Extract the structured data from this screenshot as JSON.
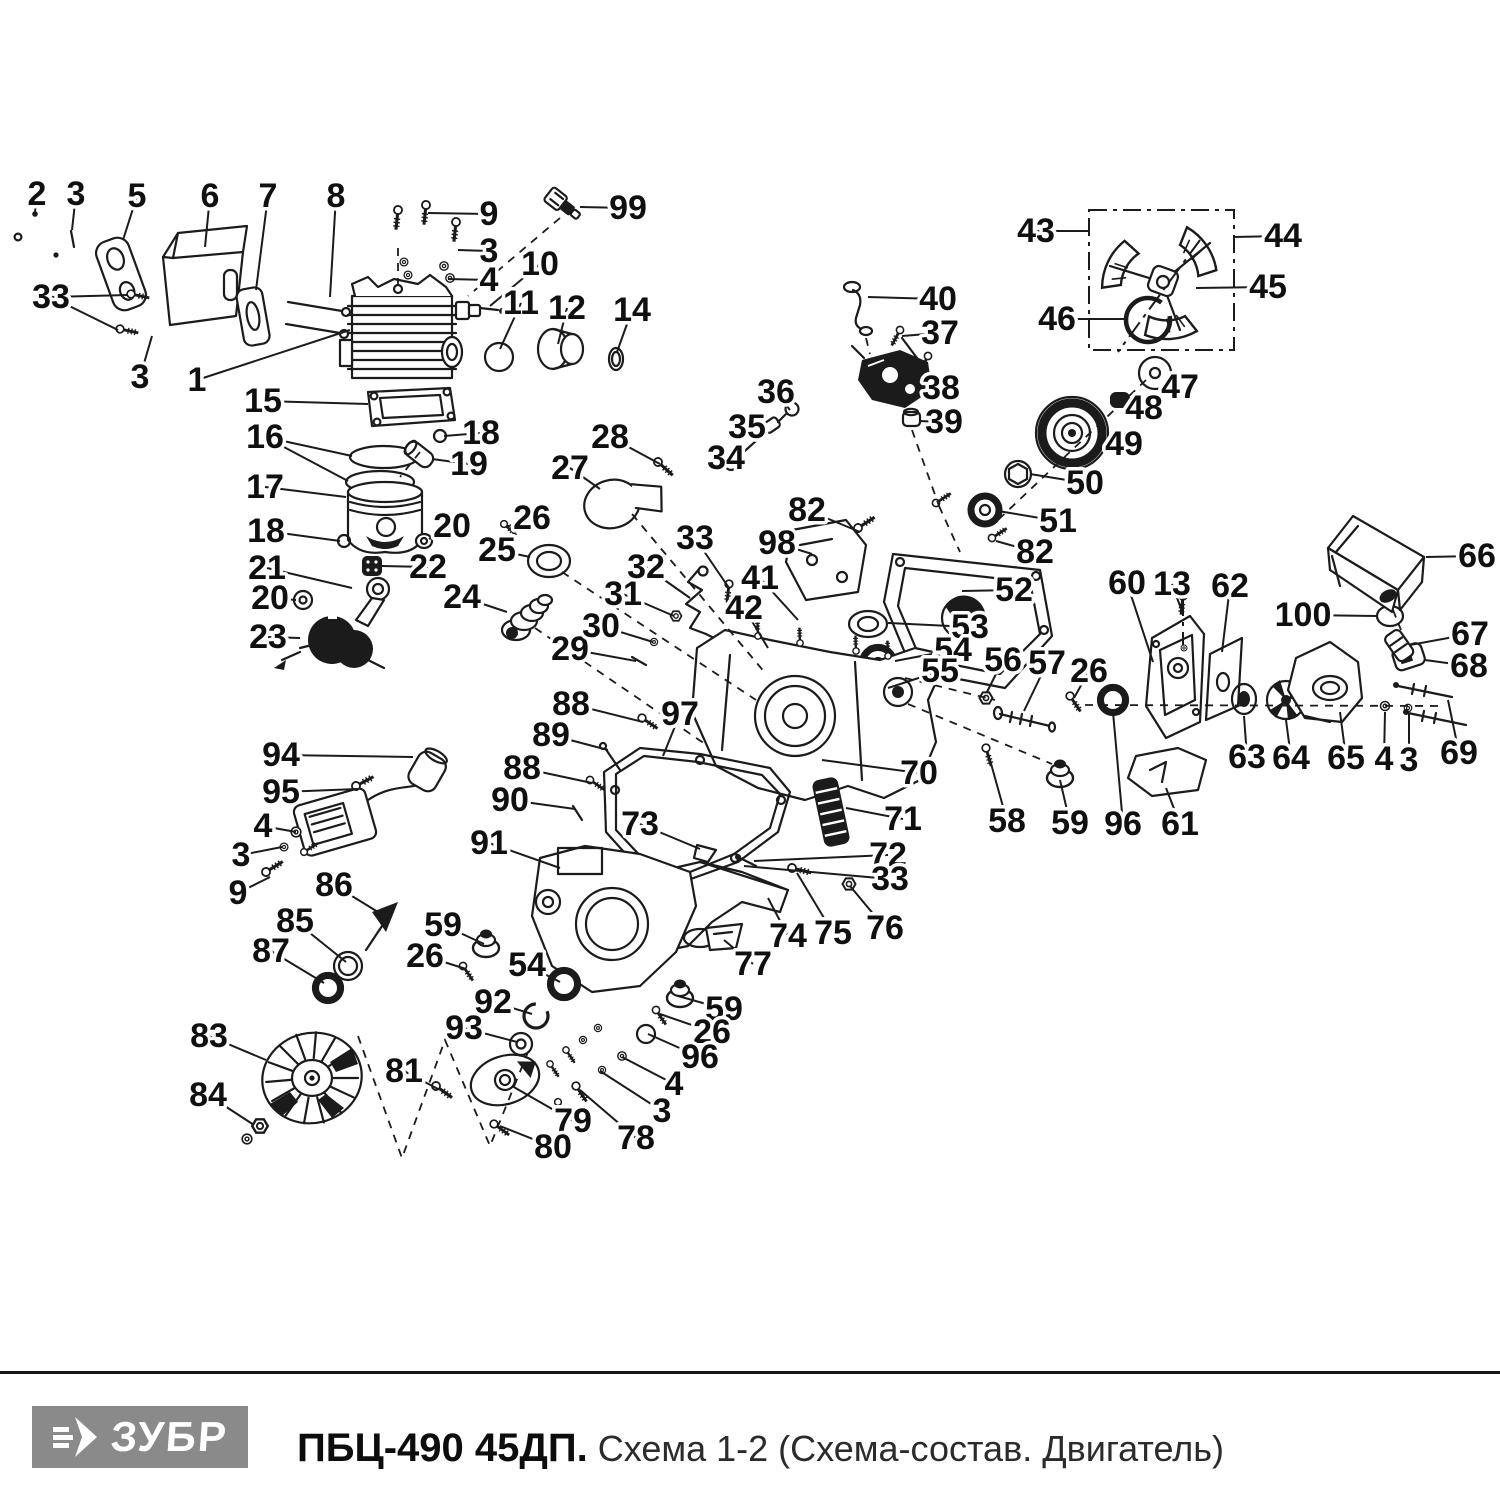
{
  "footer": {
    "brand": "ЗУБР",
    "model": "ПБЦ-490 45ДП.",
    "subtitle": " Схема 1-2 (Схема-состав. Двигатель)"
  },
  "colors": {
    "ink": "#1b1b1b",
    "logo_bg": "#8a8a8a",
    "logo_text": "#ffffff",
    "paper": "#ffffff"
  },
  "diagram": {
    "description": "Exploded engine parts schematic with numbered callouts",
    "labels": [
      {
        "n": "2",
        "x": 37,
        "y": 194,
        "t": [
          [
            35,
            212
          ]
        ]
      },
      {
        "n": "3",
        "x": 76,
        "y": 194,
        "t": [
          [
            72,
            230
          ]
        ]
      },
      {
        "n": "5",
        "x": 137,
        "y": 196,
        "t": [
          [
            123,
            240
          ]
        ]
      },
      {
        "n": "6",
        "x": 210,
        "y": 196,
        "t": [
          [
            205,
            247
          ]
        ]
      },
      {
        "n": "7",
        "x": 268,
        "y": 196,
        "t": [
          [
            256,
            290
          ]
        ]
      },
      {
        "n": "8",
        "x": 336,
        "y": 196,
        "t": [
          [
            330,
            297
          ]
        ]
      },
      {
        "n": "9",
        "x": 489,
        "y": 214,
        "t": [
          [
            428,
            213
          ]
        ]
      },
      {
        "n": "99",
        "x": 628,
        "y": 208,
        "t": [
          [
            580,
            207
          ]
        ]
      },
      {
        "n": "3",
        "x": 489,
        "y": 251,
        "t": [
          [
            458,
            250
          ]
        ]
      },
      {
        "n": "4",
        "x": 489,
        "y": 280,
        "t": [
          [
            448,
            279
          ]
        ]
      },
      {
        "n": "10",
        "x": 540,
        "y": 264,
        "t": [
          [
            490,
            306
          ]
        ]
      },
      {
        "n": "11",
        "x": 521,
        "y": 303,
        "t": [
          [
            500,
            349
          ]
        ]
      },
      {
        "n": "12",
        "x": 567,
        "y": 308,
        "t": [
          [
            558,
            344
          ]
        ]
      },
      {
        "n": "14",
        "x": 632,
        "y": 310,
        "t": [
          [
            617,
            352
          ]
        ]
      },
      {
        "n": "33",
        "x": 51,
        "y": 297,
        "t": [
          [
            128,
            295
          ],
          [
            118,
            330
          ]
        ]
      },
      {
        "n": "3",
        "x": 140,
        "y": 377,
        "t": [
          [
            152,
            336
          ]
        ]
      },
      {
        "n": "1",
        "x": 197,
        "y": 380,
        "t": [
          [
            350,
            330
          ]
        ]
      },
      {
        "n": "15",
        "x": 263,
        "y": 401,
        "t": [
          [
            368,
            404
          ]
        ]
      },
      {
        "n": "16",
        "x": 265,
        "y": 437,
        "t": [
          [
            352,
            456
          ],
          [
            348,
            481
          ]
        ]
      },
      {
        "n": "17",
        "x": 265,
        "y": 487,
        "t": [
          [
            346,
            497
          ]
        ]
      },
      {
        "n": "18",
        "x": 266,
        "y": 531,
        "t": [
          [
            340,
            541
          ]
        ]
      },
      {
        "n": "18",
        "x": 481,
        "y": 433,
        "t": [
          [
            444,
            436
          ]
        ]
      },
      {
        "n": "19",
        "x": 469,
        "y": 464,
        "t": [
          [
            432,
            459
          ]
        ]
      },
      {
        "n": "20",
        "x": 452,
        "y": 526,
        "t": [
          [
            429,
            539
          ]
        ]
      },
      {
        "n": "22",
        "x": 428,
        "y": 567,
        "t": [
          [
            380,
            566
          ]
        ]
      },
      {
        "n": "21",
        "x": 267,
        "y": 568,
        "t": [
          [
            352,
            588
          ]
        ]
      },
      {
        "n": "20",
        "x": 270,
        "y": 598,
        "t": [
          [
            296,
            600
          ]
        ]
      },
      {
        "n": "23",
        "x": 268,
        "y": 637,
        "t": [
          [
            300,
            638
          ]
        ]
      },
      {
        "n": "26",
        "x": 532,
        "y": 518,
        "t": [
          [
            506,
            527
          ]
        ]
      },
      {
        "n": "25",
        "x": 497,
        "y": 550,
        "t": [
          [
            530,
            557
          ]
        ]
      },
      {
        "n": "24",
        "x": 462,
        "y": 597,
        "t": [
          [
            507,
            612
          ]
        ]
      },
      {
        "n": "27",
        "x": 570,
        "y": 468,
        "t": [
          [
            600,
            489
          ]
        ]
      },
      {
        "n": "28",
        "x": 610,
        "y": 437,
        "t": [
          [
            660,
            464
          ]
        ]
      },
      {
        "n": "36",
        "x": 776,
        "y": 392,
        "t": [
          [
            790,
            410
          ]
        ]
      },
      {
        "n": "35",
        "x": 747,
        "y": 427,
        "t": [
          [
            757,
            441
          ]
        ]
      },
      {
        "n": "34",
        "x": 726,
        "y": 458,
        "t": [
          [
            731,
            464
          ]
        ]
      },
      {
        "n": "40",
        "x": 938,
        "y": 299,
        "t": [
          [
            868,
            297
          ]
        ]
      },
      {
        "n": "37",
        "x": 940,
        "y": 333,
        "t": [
          [
            902,
            336
          ]
        ]
      },
      {
        "n": "38",
        "x": 941,
        "y": 388,
        "t": [
          [
            920,
            385
          ]
        ]
      },
      {
        "n": "39",
        "x": 944,
        "y": 422,
        "t": [
          [
            919,
            421
          ]
        ]
      },
      {
        "n": "43",
        "x": 1036,
        "y": 231,
        "t": [
          [
            1089,
            231
          ]
        ]
      },
      {
        "n": "44",
        "x": 1283,
        "y": 236,
        "t": [
          [
            1233,
            237
          ]
        ]
      },
      {
        "n": "45",
        "x": 1268,
        "y": 287,
        "t": [
          [
            1196,
            288
          ]
        ]
      },
      {
        "n": "46",
        "x": 1057,
        "y": 319,
        "t": [
          [
            1124,
            319
          ]
        ]
      },
      {
        "n": "47",
        "x": 1180,
        "y": 387,
        "t": [
          [
            1166,
            379
          ]
        ]
      },
      {
        "n": "48",
        "x": 1144,
        "y": 408,
        "t": [
          [
            1124,
            401
          ]
        ]
      },
      {
        "n": "49",
        "x": 1124,
        "y": 444,
        "t": [
          [
            1100,
            438
          ]
        ]
      },
      {
        "n": "50",
        "x": 1085,
        "y": 483,
        "t": [
          [
            1030,
            474
          ]
        ]
      },
      {
        "n": "51",
        "x": 1058,
        "y": 521,
        "t": [
          [
            998,
            511
          ]
        ]
      },
      {
        "n": "82",
        "x": 1035,
        "y": 552,
        "t": [
          [
            996,
            541
          ]
        ]
      },
      {
        "n": "66",
        "x": 1477,
        "y": 556,
        "t": [
          [
            1426,
            557
          ]
        ]
      },
      {
        "n": "100",
        "x": 1303,
        "y": 615,
        "t": [
          [
            1376,
            616
          ]
        ]
      },
      {
        "n": "67",
        "x": 1470,
        "y": 634,
        "t": [
          [
            1410,
            645
          ]
        ]
      },
      {
        "n": "68",
        "x": 1469,
        "y": 666,
        "t": [
          [
            1425,
            660
          ]
        ]
      },
      {
        "n": "52",
        "x": 1014,
        "y": 590,
        "t": [
          [
            962,
            591
          ]
        ]
      },
      {
        "n": "53",
        "x": 970,
        "y": 627,
        "t": [
          [
            888,
            623
          ]
        ]
      },
      {
        "n": "54",
        "x": 953,
        "y": 650,
        "t": [
          [
            895,
            661
          ]
        ]
      },
      {
        "n": "55",
        "x": 940,
        "y": 671,
        "t": [
          [
            888,
            688
          ]
        ]
      },
      {
        "n": "56",
        "x": 1003,
        "y": 660,
        "t": [
          [
            987,
            692
          ]
        ]
      },
      {
        "n": "57",
        "x": 1047,
        "y": 663,
        "t": [
          [
            1024,
            711
          ]
        ]
      },
      {
        "n": "26",
        "x": 1089,
        "y": 671,
        "t": [
          [
            1074,
            698
          ]
        ]
      },
      {
        "n": "60",
        "x": 1127,
        "y": 583,
        "t": [
          [
            1153,
            662
          ]
        ]
      },
      {
        "n": "13",
        "x": 1172,
        "y": 584,
        "t": [
          [
            1183,
            614
          ]
        ]
      },
      {
        "n": "62",
        "x": 1230,
        "y": 586,
        "t": [
          [
            1222,
            652
          ]
        ]
      },
      {
        "n": "63",
        "x": 1247,
        "y": 757,
        "t": [
          [
            1244,
            716
          ]
        ]
      },
      {
        "n": "64",
        "x": 1291,
        "y": 758,
        "t": [
          [
            1286,
            720
          ]
        ]
      },
      {
        "n": "65",
        "x": 1346,
        "y": 758,
        "t": [
          [
            1340,
            712
          ]
        ]
      },
      {
        "n": "4",
        "x": 1384,
        "y": 759,
        "t": [
          [
            1385,
            712
          ]
        ]
      },
      {
        "n": "3",
        "x": 1409,
        "y": 760,
        "t": [
          [
            1409,
            714
          ]
        ]
      },
      {
        "n": "69",
        "x": 1459,
        "y": 753,
        "t": [
          [
            1448,
            700
          ]
        ]
      },
      {
        "n": "58",
        "x": 1007,
        "y": 821,
        "t": [
          [
            990,
            760
          ]
        ]
      },
      {
        "n": "59",
        "x": 1070,
        "y": 823,
        "t": [
          [
            1060,
            780
          ]
        ]
      },
      {
        "n": "96",
        "x": 1123,
        "y": 824,
        "t": [
          [
            1113,
            712
          ]
        ]
      },
      {
        "n": "61",
        "x": 1180,
        "y": 824,
        "t": [
          [
            1166,
            788
          ]
        ]
      },
      {
        "n": "70",
        "x": 919,
        "y": 773,
        "t": [
          [
            822,
            760
          ]
        ]
      },
      {
        "n": "71",
        "x": 903,
        "y": 819,
        "t": [
          [
            846,
            808
          ]
        ]
      },
      {
        "n": "72",
        "x": 888,
        "y": 855,
        "t": [
          [
            754,
            861
          ]
        ]
      },
      {
        "n": "33",
        "x": 890,
        "y": 879,
        "t": [
          [
            744,
            866
          ]
        ]
      },
      {
        "n": "74",
        "x": 788,
        "y": 936,
        "t": [
          [
            768,
            898
          ]
        ]
      },
      {
        "n": "75",
        "x": 833,
        "y": 933,
        "t": [
          [
            797,
            873
          ]
        ]
      },
      {
        "n": "76",
        "x": 885,
        "y": 928,
        "t": [
          [
            850,
            886
          ]
        ]
      },
      {
        "n": "77",
        "x": 753,
        "y": 964,
        "t": [
          [
            724,
            940
          ]
        ]
      },
      {
        "n": "73",
        "x": 640,
        "y": 824,
        "t": [
          [
            700,
            849
          ]
        ]
      },
      {
        "n": "88",
        "x": 571,
        "y": 704,
        "t": [
          [
            643,
            722
          ]
        ]
      },
      {
        "n": "89",
        "x": 551,
        "y": 735,
        "t": [
          [
            608,
            750
          ]
        ]
      },
      {
        "n": "88",
        "x": 522,
        "y": 768,
        "t": [
          [
            592,
            783
          ]
        ]
      },
      {
        "n": "90",
        "x": 510,
        "y": 800,
        "t": [
          [
            575,
            809
          ]
        ]
      },
      {
        "n": "97",
        "x": 680,
        "y": 714,
        "t": [
          [
            663,
            756
          ]
        ]
      },
      {
        "n": "91",
        "x": 489,
        "y": 843,
        "t": [
          [
            560,
            868
          ]
        ]
      },
      {
        "n": "94",
        "x": 281,
        "y": 755,
        "t": [
          [
            413,
            757
          ]
        ]
      },
      {
        "n": "95",
        "x": 281,
        "y": 792,
        "t": [
          [
            358,
            789
          ]
        ]
      },
      {
        "n": "4",
        "x": 263,
        "y": 826,
        "t": [
          [
            296,
            832
          ]
        ]
      },
      {
        "n": "3",
        "x": 241,
        "y": 855,
        "t": [
          [
            282,
            847
          ]
        ]
      },
      {
        "n": "9",
        "x": 238,
        "y": 893,
        "t": [
          [
            270,
            877
          ]
        ]
      },
      {
        "n": "86",
        "x": 334,
        "y": 885,
        "t": [
          [
            378,
            912
          ]
        ]
      },
      {
        "n": "85",
        "x": 295,
        "y": 921,
        "t": [
          [
            346,
            962
          ]
        ]
      },
      {
        "n": "87",
        "x": 271,
        "y": 951,
        "t": [
          [
            324,
            983
          ]
        ]
      },
      {
        "n": "83",
        "x": 209,
        "y": 1036,
        "t": [
          [
            266,
            1060
          ]
        ]
      },
      {
        "n": "84",
        "x": 208,
        "y": 1095,
        "t": [
          [
            254,
            1125
          ]
        ]
      },
      {
        "n": "81",
        "x": 404,
        "y": 1071,
        "t": [
          [
            438,
            1089
          ]
        ]
      },
      {
        "n": "79",
        "x": 573,
        "y": 1121,
        "t": [
          [
            512,
            1086
          ]
        ]
      },
      {
        "n": "80",
        "x": 553,
        "y": 1147,
        "t": [
          [
            500,
            1126
          ]
        ]
      },
      {
        "n": "92",
        "x": 493,
        "y": 1002,
        "t": [
          [
            532,
            1014
          ]
        ]
      },
      {
        "n": "93",
        "x": 464,
        "y": 1028,
        "t": [
          [
            517,
            1042
          ]
        ]
      },
      {
        "n": "59",
        "x": 443,
        "y": 925,
        "t": [
          [
            484,
            944
          ]
        ]
      },
      {
        "n": "26",
        "x": 425,
        "y": 956,
        "t": [
          [
            466,
            969
          ]
        ]
      },
      {
        "n": "54",
        "x": 527,
        "y": 965,
        "t": [
          [
            560,
            982
          ]
        ]
      },
      {
        "n": "59",
        "x": 724,
        "y": 1009,
        "t": [
          [
            678,
            996
          ]
        ]
      },
      {
        "n": "26",
        "x": 712,
        "y": 1032,
        "t": [
          [
            660,
            1014
          ]
        ]
      },
      {
        "n": "96",
        "x": 700,
        "y": 1057,
        "t": [
          [
            648,
            1034
          ]
        ]
      },
      {
        "n": "4",
        "x": 674,
        "y": 1084,
        "t": [
          [
            622,
            1057
          ]
        ]
      },
      {
        "n": "3",
        "x": 662,
        "y": 1111,
        "t": [
          [
            600,
            1071
          ]
        ]
      },
      {
        "n": "78",
        "x": 636,
        "y": 1138,
        "t": [
          [
            580,
            1090
          ]
        ]
      },
      {
        "n": "29",
        "x": 570,
        "y": 649,
        "t": [
          [
            636,
            661
          ]
        ]
      },
      {
        "n": "30",
        "x": 601,
        "y": 626,
        "t": [
          [
            653,
            642
          ]
        ]
      },
      {
        "n": "31",
        "x": 623,
        "y": 594,
        "t": [
          [
            674,
            616
          ]
        ]
      },
      {
        "n": "32",
        "x": 646,
        "y": 567,
        "t": [
          [
            690,
            598
          ]
        ]
      },
      {
        "n": "33",
        "x": 695,
        "y": 538,
        "t": [
          [
            729,
            588
          ]
        ]
      },
      {
        "n": "41",
        "x": 760,
        "y": 578,
        "t": [
          [
            798,
            620
          ]
        ]
      },
      {
        "n": "42",
        "x": 744,
        "y": 608,
        "t": [
          [
            768,
            648
          ]
        ]
      },
      {
        "n": "82",
        "x": 807,
        "y": 510,
        "t": [
          [
            860,
            532
          ]
        ]
      },
      {
        "n": "98",
        "x": 777,
        "y": 543,
        "t": [
          [
            812,
            554
          ]
        ]
      }
    ]
  }
}
